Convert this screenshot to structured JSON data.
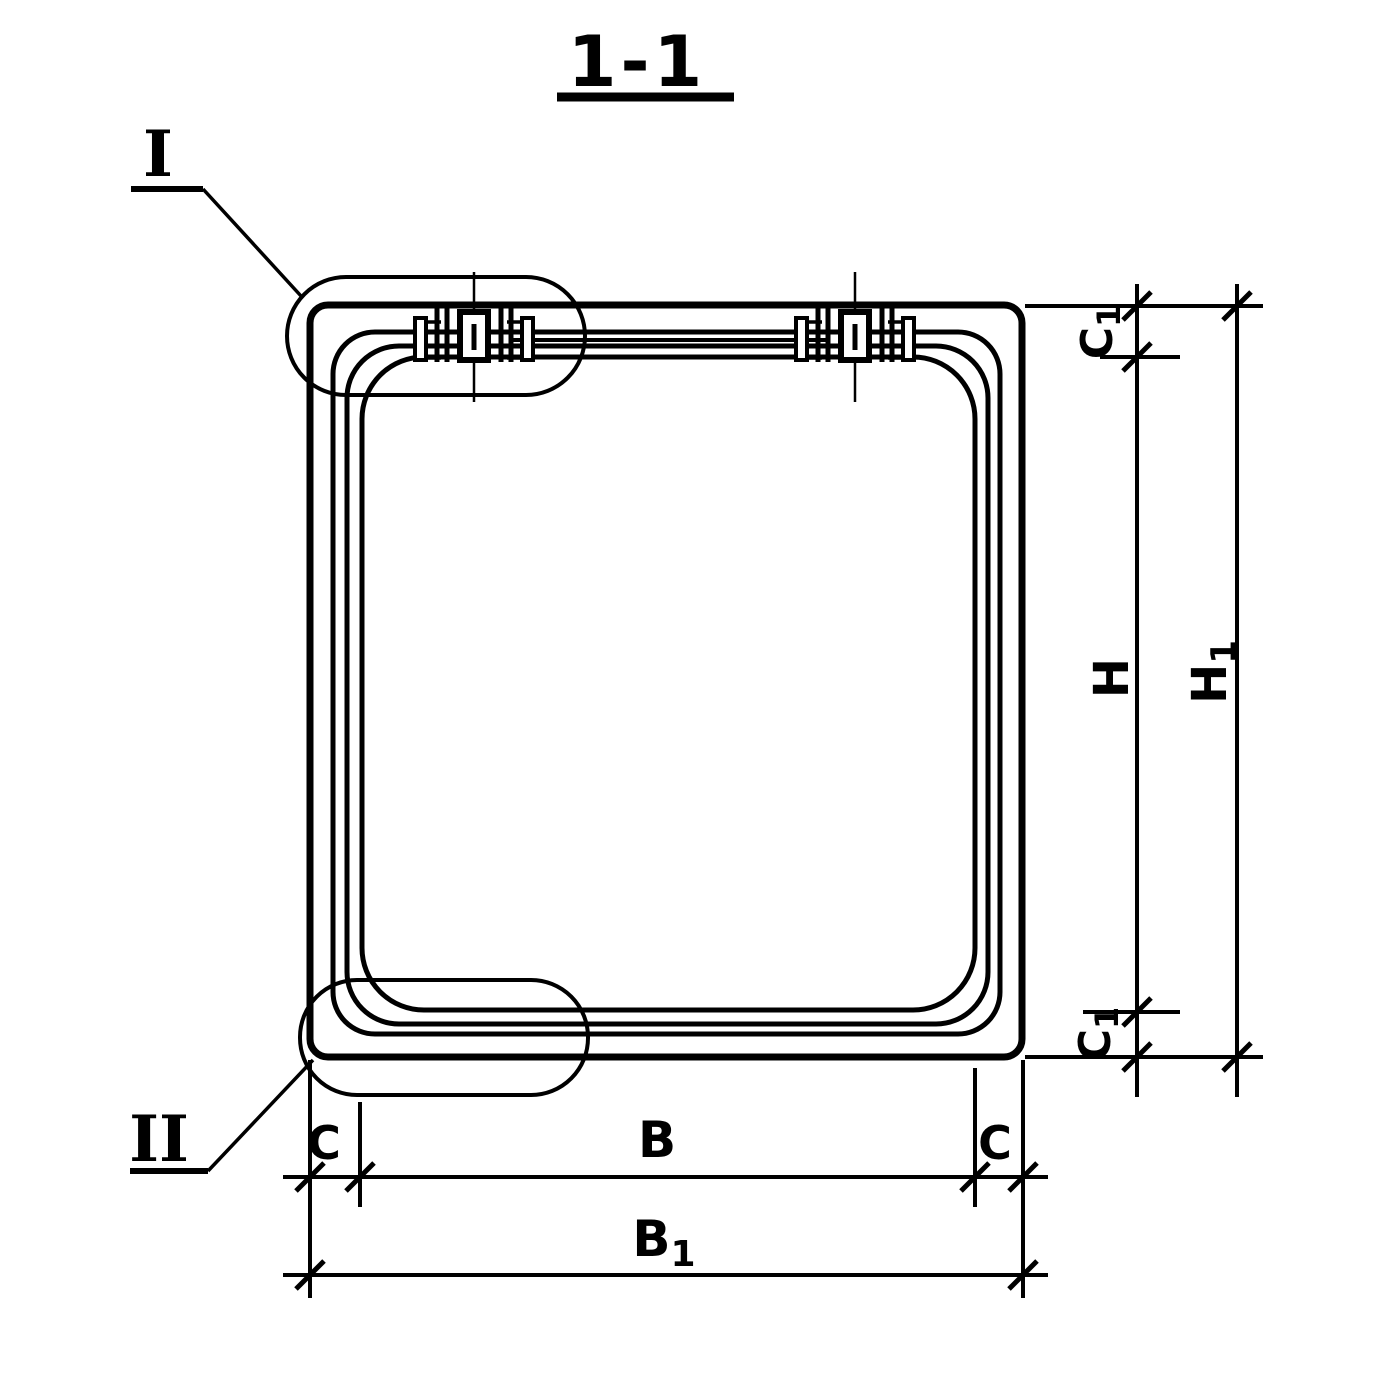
{
  "title": "1-1",
  "detail_callouts": {
    "one": "I",
    "two": "II"
  },
  "dimension_labels": {
    "c1_top": {
      "base": "C",
      "sub": "1"
    },
    "h": "H",
    "h1": {
      "base": "H",
      "sub": "1"
    },
    "c1_bottom": {
      "base": "C",
      "sub": "1"
    },
    "c_left": "C",
    "b": "B",
    "c_right": "C",
    "b1": {
      "base": "B",
      "sub": "1"
    }
  },
  "colors": {
    "ink": "#000000",
    "paper": "#ffffff"
  }
}
